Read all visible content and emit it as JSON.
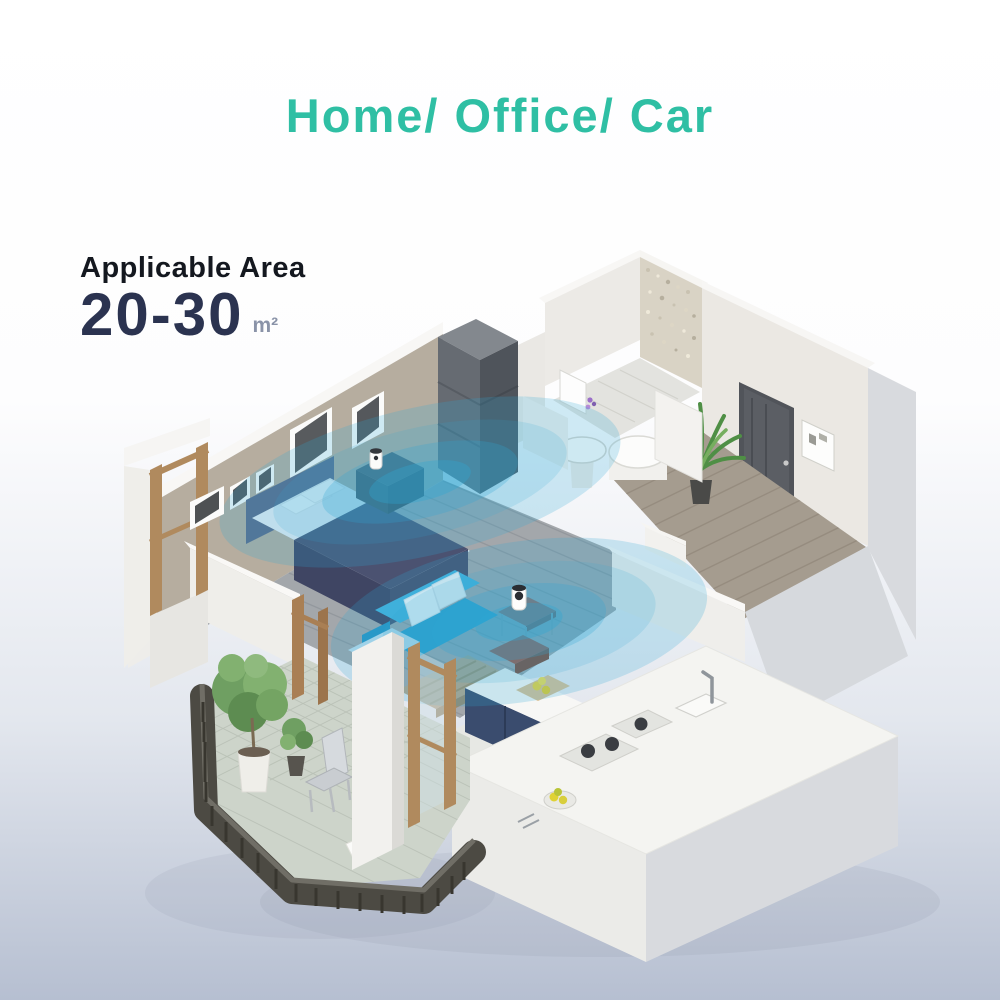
{
  "header": {
    "title": "Home/ Office/ Car"
  },
  "area": {
    "label": "Applicable Area",
    "value": "20-30",
    "unit": "m²"
  },
  "colors": {
    "accent": "#2fbfa4",
    "heading": "#14181f",
    "area-value": "#2b3350",
    "area-unit": "#8a93a8",
    "signal": "#2fa8d4",
    "sofa": "#2d9fce",
    "cabinet-navy": "#3a4c6e",
    "wall": "#edebe7"
  },
  "scene": {
    "rooms": [
      "bedroom",
      "bathroom",
      "entry-hall",
      "living-room",
      "kitchen",
      "balcony"
    ],
    "devices": [
      "camera-device-bedroom",
      "camera-device-living-room"
    ]
  }
}
